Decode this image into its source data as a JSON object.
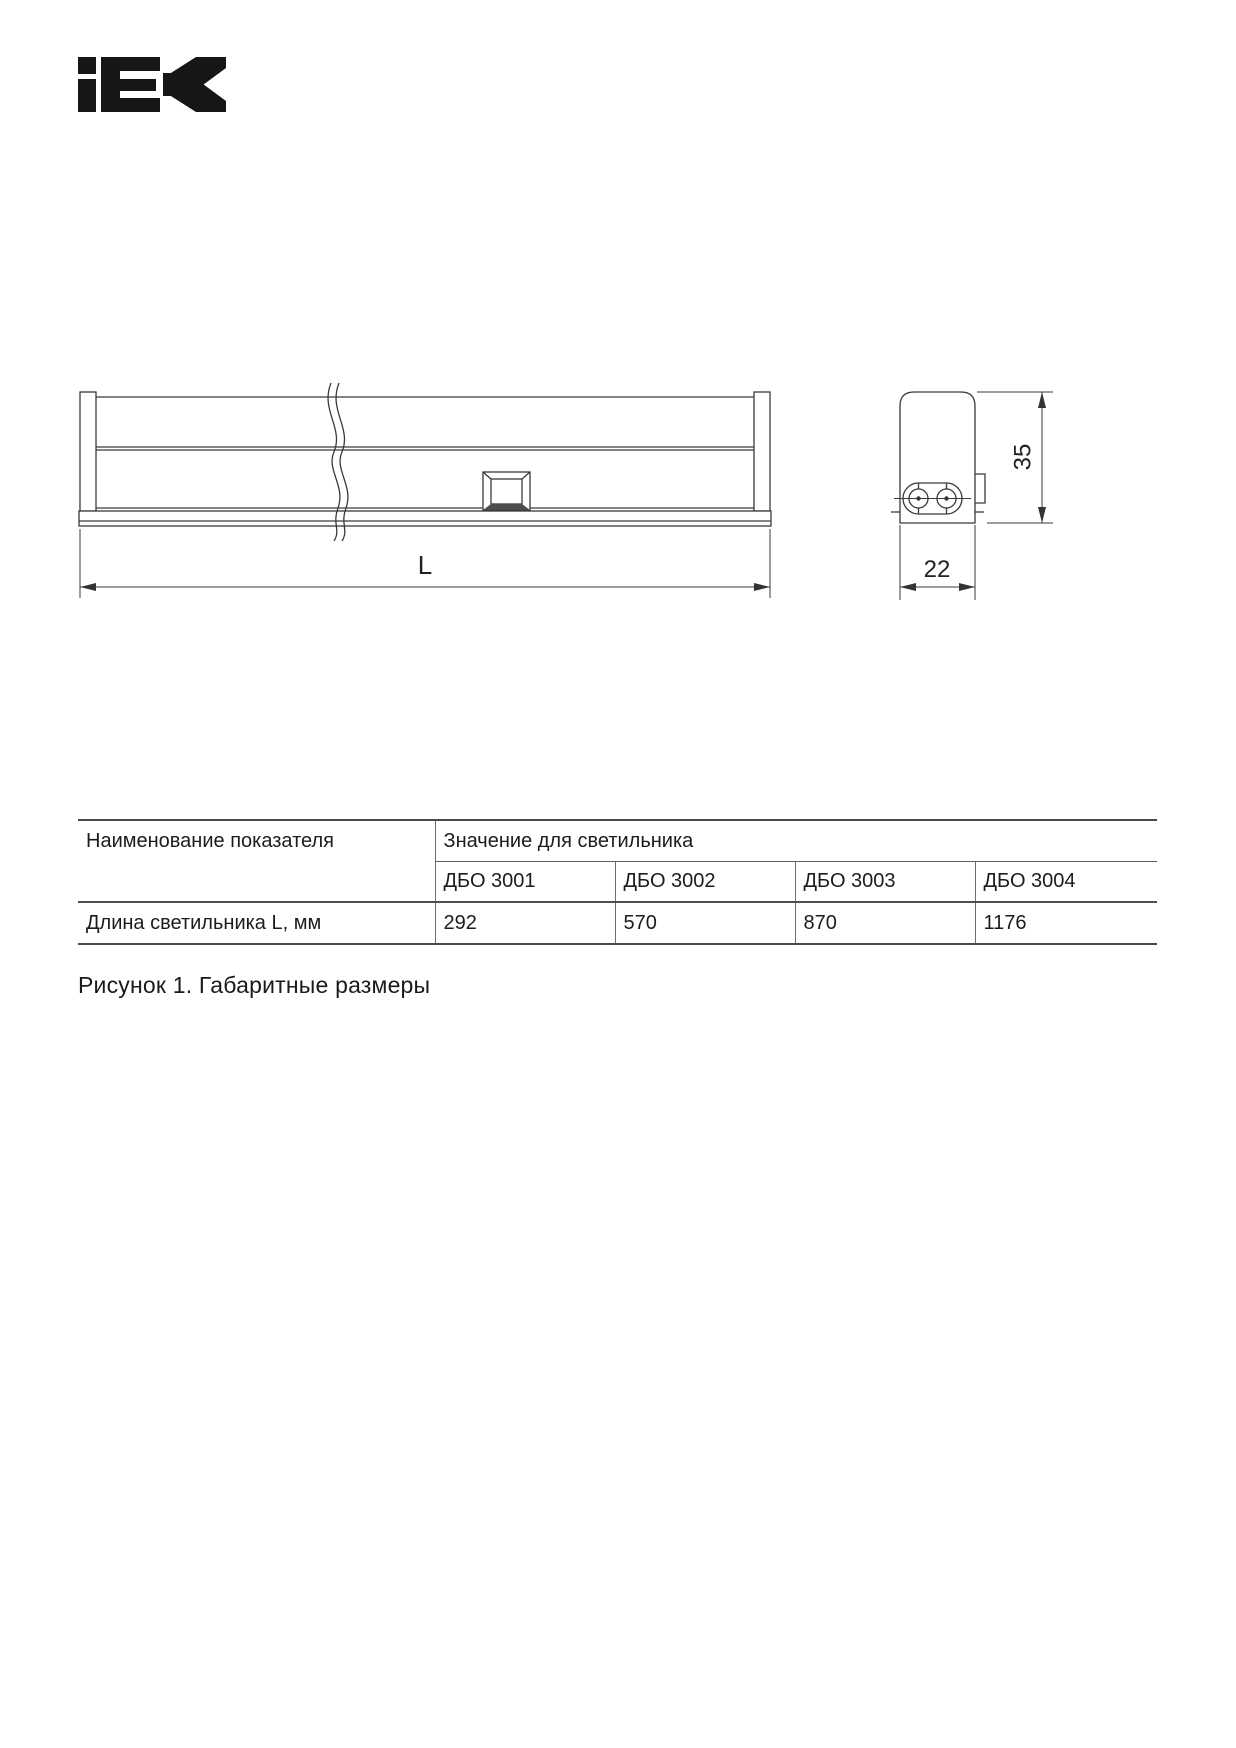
{
  "logo": {
    "brand": "IEK"
  },
  "figure": {
    "length_label": "L",
    "height_label": "35",
    "depth_label": "22"
  },
  "table": {
    "col1_header": "Наименование показателя",
    "group_header": "Значение для светильника",
    "models": [
      "ДБО 3001",
      "ДБО 3002",
      "ДБО 3003",
      "ДБО 3004"
    ],
    "row_label": "Длина светильника L, мм",
    "values": [
      "292",
      "570",
      "870",
      "1176"
    ]
  },
  "caption": "Рисунок 1. Габаритные размеры"
}
